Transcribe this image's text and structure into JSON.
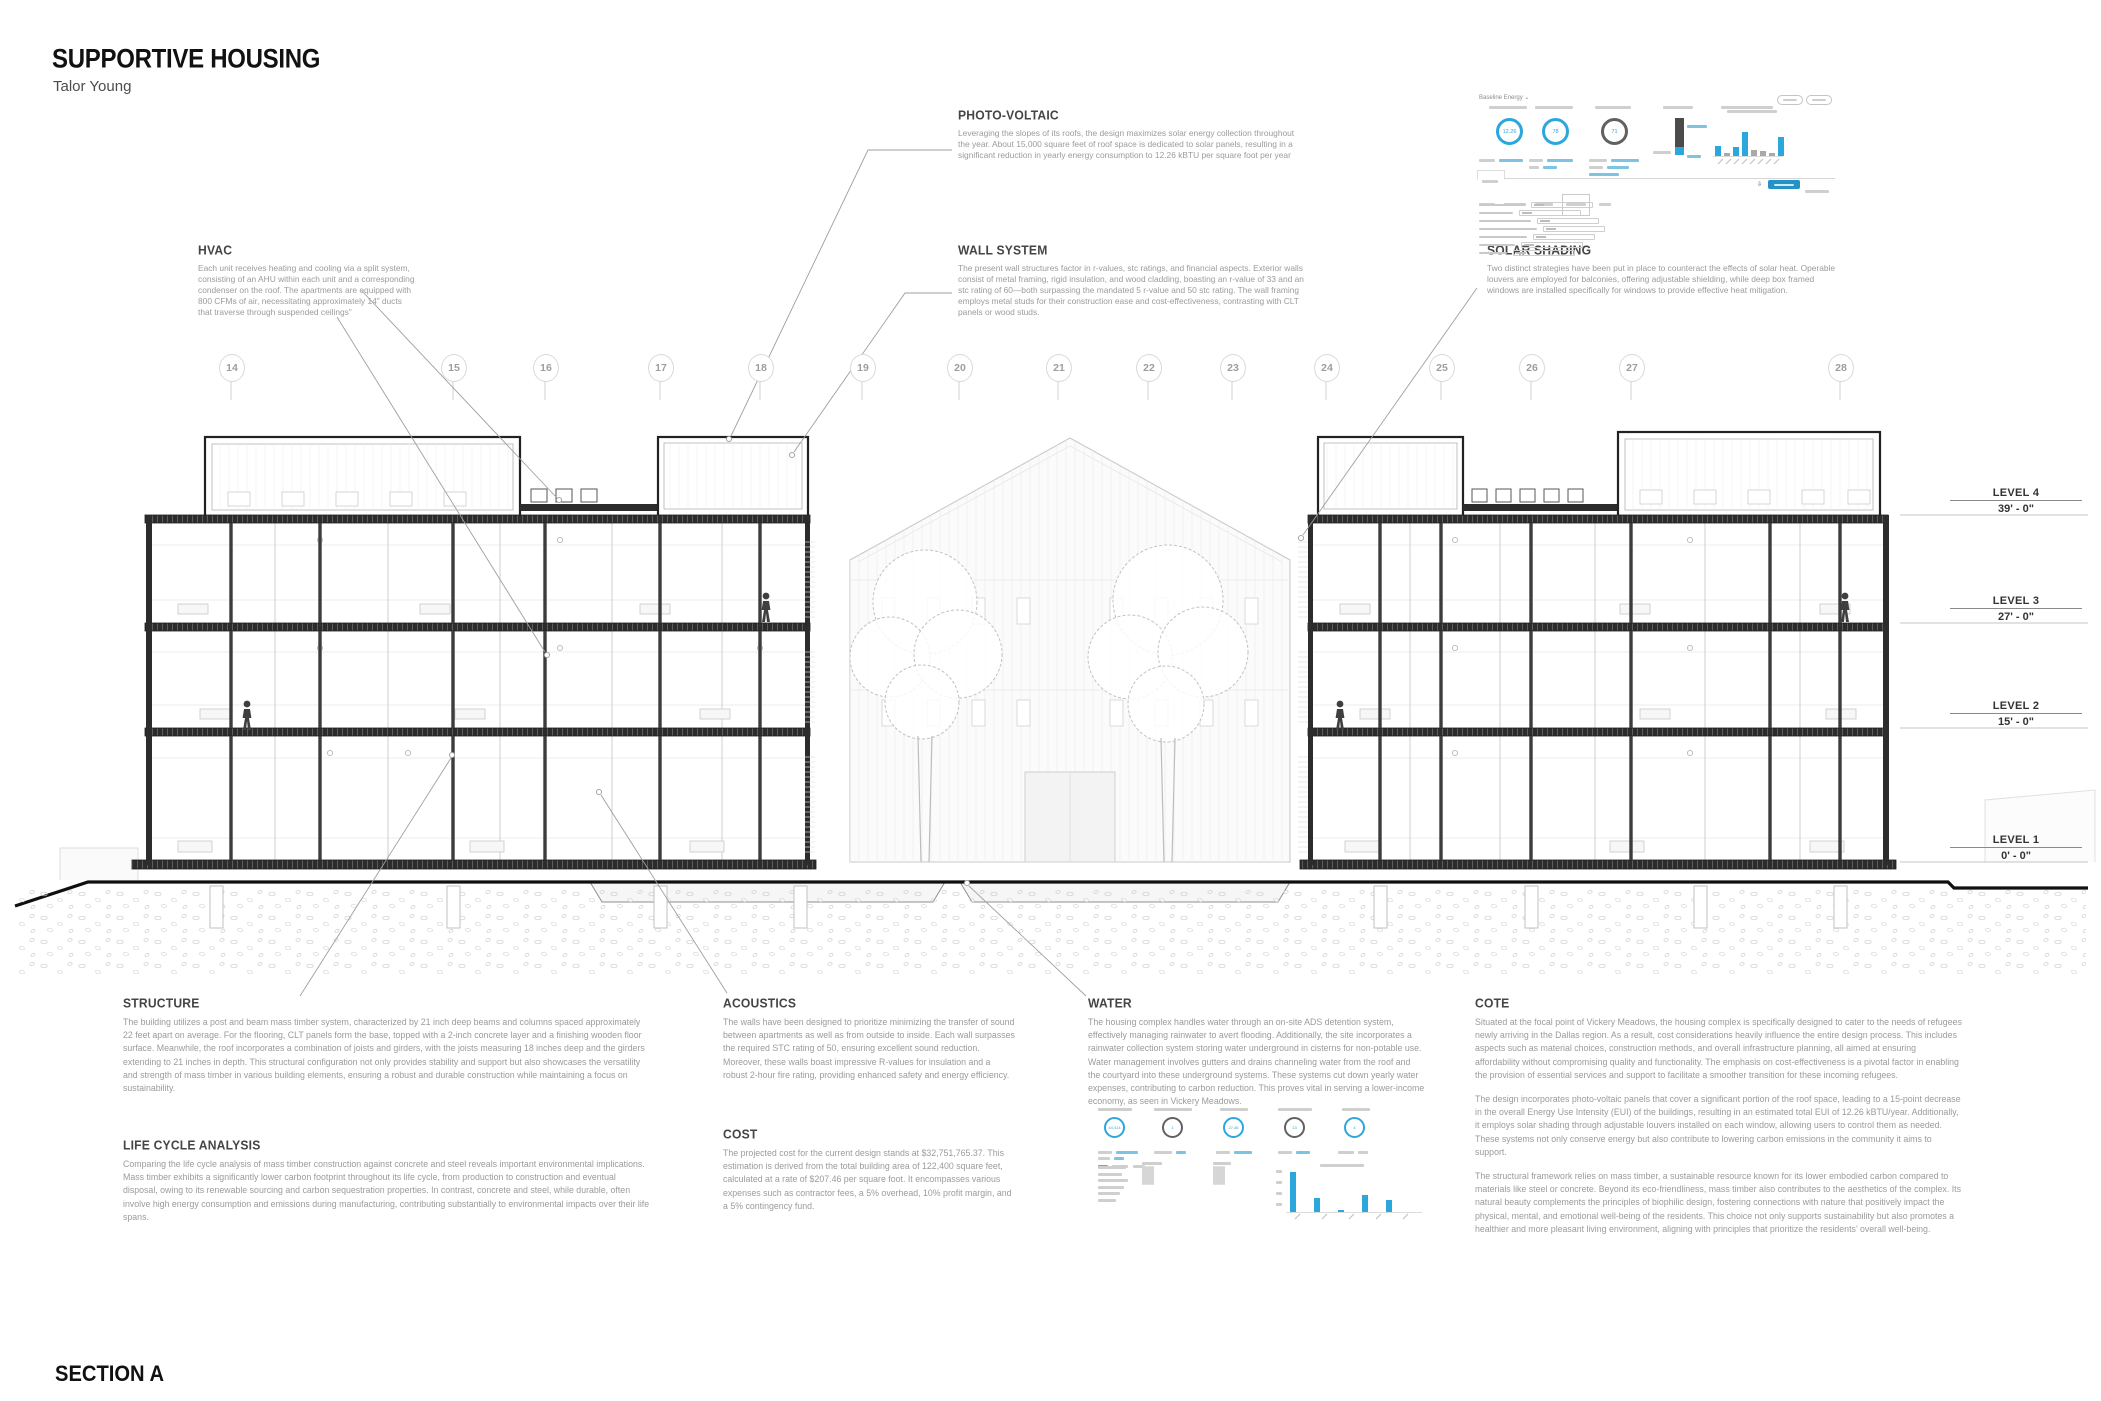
{
  "title": {
    "main": "SUPPORTIVE HOUSING",
    "author": "Talor Young",
    "section_label": "SECTION A"
  },
  "annotations": [
    {
      "id": "hvac",
      "heading": "HVAC",
      "body": "Each unit receives heating and cooling via a split system, consisting of an AHU within each unit and a corresponding condenser on the roof. The apartments are equipped with 800 CFMs of air, necessitating approximately 14” ducts that traverse through suspended ceilings”"
    },
    {
      "id": "photo-voltaic",
      "heading": "PHOTO-VOLTAIC",
      "body": "Leveraging the slopes of its roofs, the design maximizes solar energy collection throughout the year. About 15,000 square feet of roof space is dedicated to solar panels, resulting in a significant reduction in yearly energy consumption to 12.26 kBTU per square foot per year"
    },
    {
      "id": "wall-system",
      "heading": "WALL SYSTEM",
      "body": "The present wall structures factor in r-values, stc ratings, and financial aspects. Exterior walls consist of metal framing, rigid insulation, and wood cladding, boasting an r-value of 33 and an stc rating of 60—both surpassing the mandated 5 r-value and 50 stc rating. The wall framing employs metal studs for their construction ease and cost-effectiveness, contrasting with CLT panels or wood studs."
    },
    {
      "id": "solar-shading",
      "heading": "SOLAR SHADING",
      "body": "Two distinct strategies have been put in place to counteract the effects of solar heat. Operable louvers are employed for balconies, offering adjustable shielding, while deep box framed windows are installed specifically for windows to provide effective heat mitigation."
    },
    {
      "id": "structure",
      "heading": "STRUCTURE",
      "body": "The building utilizes a post and beam mass timber system, characterized by 21 inch deep beams and columns spaced approximately 22 feet apart on average. For the flooring, CLT panels form the base, topped with a 2-inch concrete layer and a finishing wooden floor surface. Meanwhile, the roof incorporates a combination of joists and girders, with the joists measuring 18 inches deep and the girders extending to 21 inches in depth. This structural configuration not only provides stability and support but also showcases the versatility and strength of mass timber in various building elements, ensuring a robust and durable construction while maintaining a focus on sustainability."
    },
    {
      "id": "life-cycle-analysis",
      "heading": "LIFE CYCLE ANALYSIS",
      "body": "Comparing the life cycle analysis of mass timber construction against concrete and steel reveals important environmental implications. Mass timber exhibits a significantly lower carbon footprint throughout its life cycle, from production to construction and eventual disposal, owing to its renewable sourcing and carbon sequestration properties. In contrast, concrete and steel, while durable, often involve high energy consumption and emissions during manufacturing, contributing substantially to environmental impacts over their life spans."
    },
    {
      "id": "acoustics",
      "heading": "ACOUSTICS",
      "body": "The walls have been designed to prioritize minimizing the transfer of sound between apartments as well as from outside to inside. Each wall surpasses the required STC rating of 50, ensuring excellent sound reduction. Moreover, these walls boast impressive R-values for insulation and a robust 2-hour fire rating, providing enhanced safety and energy efficiency."
    },
    {
      "id": "cost",
      "heading": "COST",
      "body": "The projected cost for the current design stands at $32,751,765.37. This estimation is derived from the total building area of 122,400 square feet, calculated at a rate of $207.46 per square foot. It encompasses various expenses such as contractor fees, a 5% overhead, 10% profit margin, and a 5% contingency fund."
    },
    {
      "id": "water",
      "heading": "WATER",
      "body": "The housing complex handles water through an on-site ADS detention system, effectively managing rainwater to avert flooding. Additionally, the site incorporates a rainwater collection system storing water underground in cisterns for non-potable use. Water management involves gutters and drains channeling water from the roof and the courtyard into these underground systems. These systems cut down yearly water expenses, contributing to carbon reduction. This proves vital in serving a lower-income economy, as seen in Vickery Meadows."
    }
  ],
  "cote": {
    "heading": "COTE",
    "p1": "Situated at the focal point of Vickery Meadows, the housing complex is specifically designed to cater to the needs of refugees newly arriving in the Dallas region. As a result, cost considerations heavily influence the entire design process. This includes aspects such as material choices, construction methods, and overall infrastructure planning, all aimed at ensuring affordability without compromising quality and functionality. The emphasis on cost-effectiveness is a pivotal factor in enabling the provision of essential services and support to facilitate a smoother transition for these incoming refugees.",
    "p2": "The design incorporates photo-voltaic panels that cover a significant portion of the roof space, leading to a 15-point decrease in the overall Energy Use Intensity (EUI) of the buildings, resulting in an estimated total EUI of 12.26 kBTU/year. Additionally, it employs solar shading through adjustable louvers installed on each window, allowing users to control them as needed. These systems not only conserve energy but also contribute to lowering carbon emissions in the community it aims to support.",
    "p3": "The structural framework relies on mass timber, a sustainable resource known for its lower embodied carbon compared to materials like steel or concrete. Beyond its eco-friendliness, mass timber also contributes to the aesthetics of the complex. Its natural beauty complements the principles of biophilic design, fostering connections with nature that positively impact the physical, mental, and emotional well-being of the residents. This choice not only supports sustainability but also promotes a healthier and more pleasant living environment, aligning with principles that prioritize the residents’ overall well-being."
  },
  "grid": {
    "labels": [
      "14",
      "15",
      "16",
      "17",
      "18",
      "19",
      "20",
      "21",
      "22",
      "23",
      "24",
      "25",
      "26",
      "27",
      "28"
    ]
  },
  "levels": [
    {
      "name": "LEVEL 4",
      "elevation": "39' - 0\""
    },
    {
      "name": "LEVEL 3",
      "elevation": "27' - 0\""
    },
    {
      "name": "LEVEL 2",
      "elevation": "15' - 0\""
    },
    {
      "name": "LEVEL 1",
      "elevation": "0' - 0\""
    }
  ],
  "energy_dashboard": {
    "title": "Baseline Energy ⌄",
    "donuts": [
      "12.26",
      "78",
      "71"
    ],
    "mini_chart": {
      "values": [
        10,
        3,
        9,
        24,
        6,
        5,
        3,
        19
      ],
      "colors": [
        "#2ba7dd",
        "#a9a9a9",
        "#2ba7dd",
        "#2ba7dd",
        "#a9a9a9",
        "#a9a9a9",
        "#a9a9a9",
        "#2ba7dd"
      ]
    }
  },
  "water_dashboard": {
    "donuts": [
      "44,414",
      "1",
      "27.46",
      "13",
      "4"
    ],
    "mini_chart": {
      "values": [
        40,
        14,
        2,
        17,
        12
      ],
      "colors": [
        "#2ba7dd",
        "#2ba7dd",
        "#2ba7dd",
        "#2ba7dd",
        "#2ba7dd"
      ]
    }
  },
  "chart_data": [
    {
      "type": "donut",
      "title": "Baseline Energy gauges",
      "values": [
        12.26,
        78,
        71
      ]
    },
    {
      "type": "bar",
      "title": "Baseline Energy end-use bars",
      "values": [
        10,
        3,
        9,
        24,
        6,
        5,
        3,
        19
      ]
    },
    {
      "type": "donut",
      "title": "Water dashboard gauges",
      "values": [
        44414,
        1,
        27.46,
        13,
        4
      ]
    },
    {
      "type": "bar",
      "title": "Water dashboard bars",
      "values": [
        40,
        14,
        2,
        17,
        12
      ]
    }
  ],
  "colors": {
    "accent_blue": "#2ba7dd",
    "ink": "#111111",
    "body_gray": "#9b9b9b",
    "line_gray": "#c9c9c9"
  }
}
